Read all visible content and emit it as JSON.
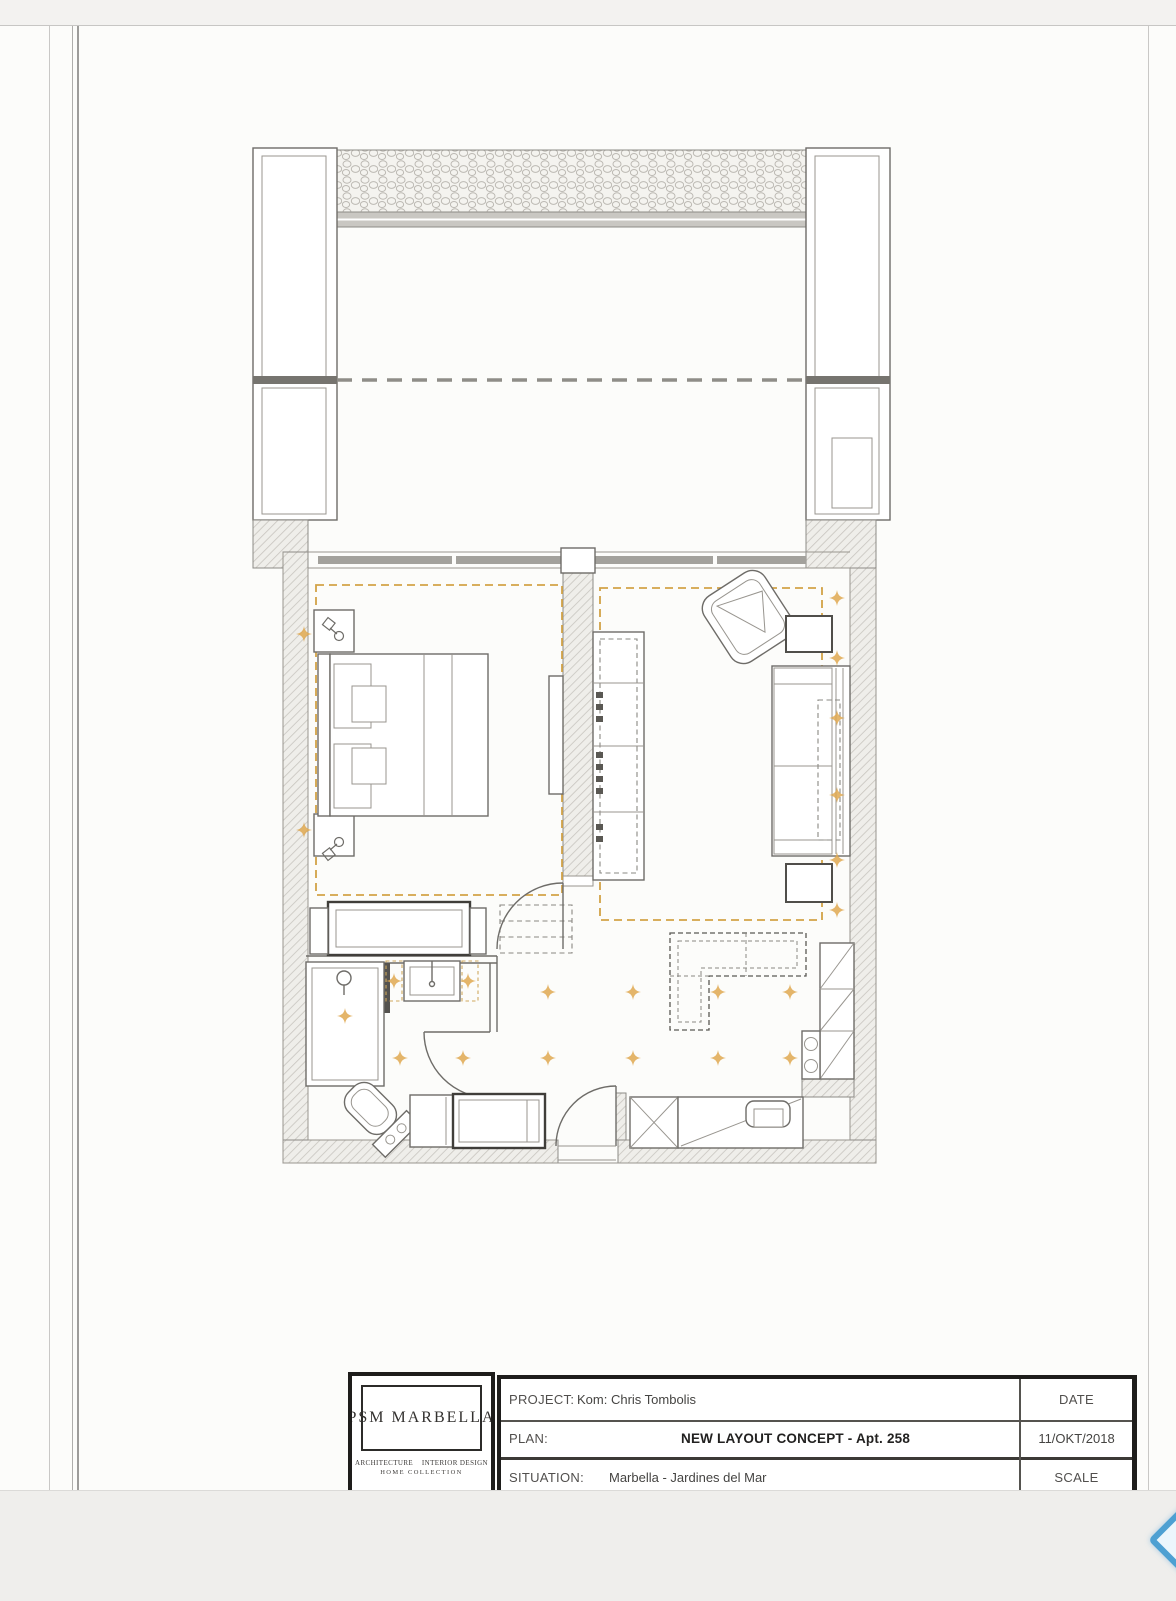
{
  "page": {
    "sheet_color": "#fcfcfa",
    "band_color": "#f2f1ef"
  },
  "viewer": {
    "prev_arrow_color": "#4ea0d2"
  },
  "plan": {
    "ceiling_dash_color": "#d2a247",
    "spotlight_color": "#dfa850",
    "wall_line_color": "#6e6c68"
  },
  "title_block": {
    "logo": {
      "name": "PSM  MARBELLA",
      "tagline_left": "ARCHITECTURE",
      "tagline_right": "INTERIOR DESIGN",
      "tagline_bottom": "HOME COLLECTION"
    },
    "project_label": "PROJECT:",
    "project_value": "Kom: Chris Tombolis",
    "plan_label": "PLAN:",
    "plan_value": "NEW LAYOUT CONCEPT  -  Apt. 258",
    "situation_label": "SITUATION:",
    "situation_value": "Marbella  -  Jardines del Mar",
    "date_label": "DATE",
    "date_value": "11/OKT/2018",
    "scale_label": "SCALE"
  }
}
